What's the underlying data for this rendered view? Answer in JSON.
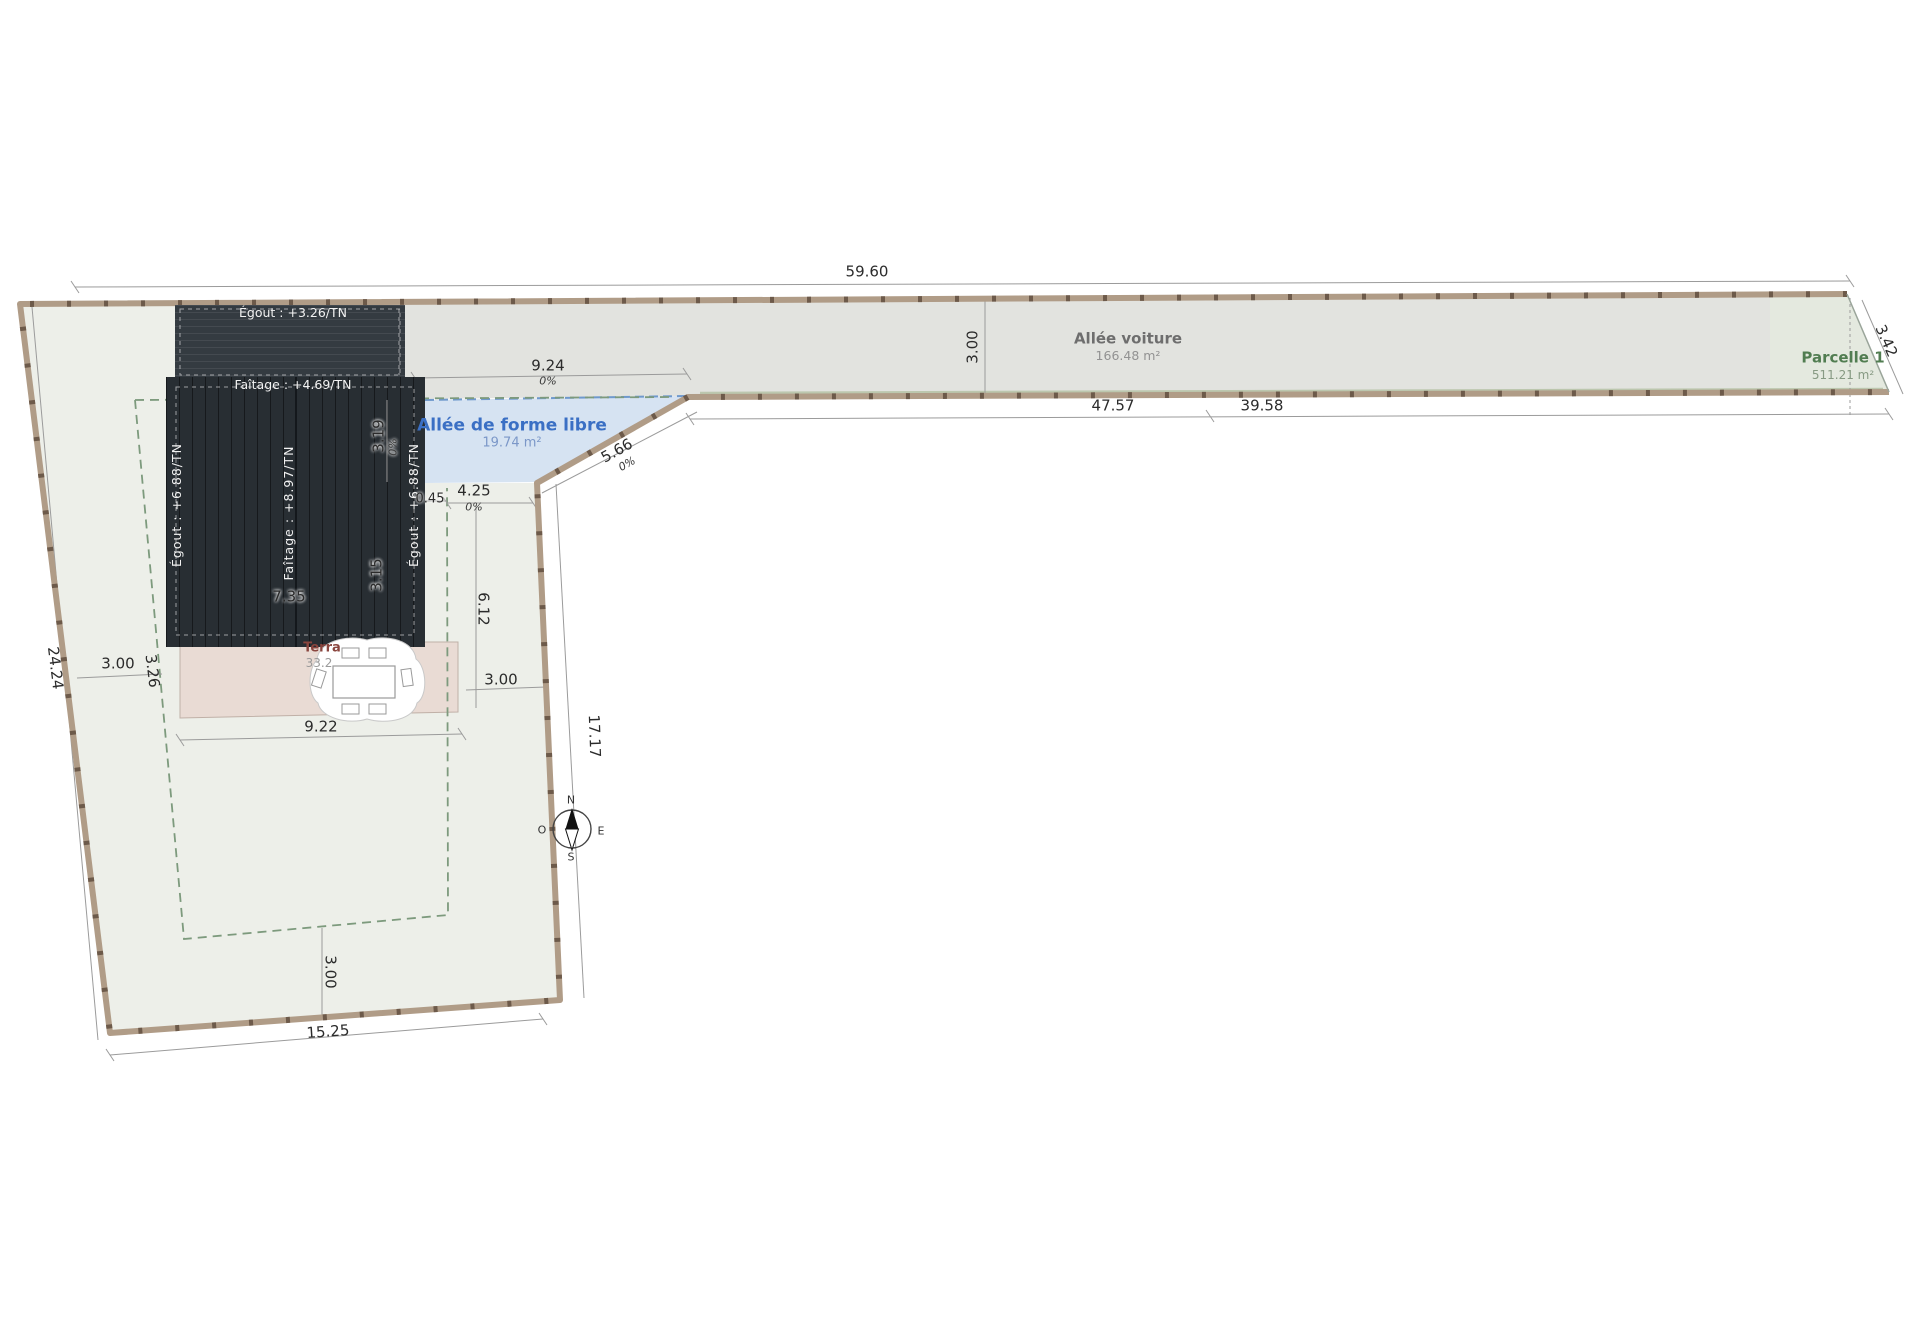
{
  "plan": {
    "dim_top": "59.60",
    "dim_strip_width": "3.00",
    "dim_4757": "47.57",
    "dim_3958": "39.58",
    "dim_342": "3.42",
    "dim_924": "9.24",
    "dim_566": "5.66",
    "dim_319": "3.19",
    "dim_315": "3.15",
    "dim_045": "0.45",
    "dim_425": "4.25",
    "dim_612": "6.12",
    "dim_735": "7.35",
    "dim_2424": "24.24",
    "dim_300_left": "3.00",
    "dim_326": "3.26",
    "dim_922": "9.22",
    "dim_300_terrace": "3.00",
    "dim_1717": "17.17",
    "dim_300_bottom": "3.00",
    "dim_1525": "15.25",
    "slope_zero": "0%"
  },
  "areas": {
    "allee_voiture": {
      "name": "Allée voiture",
      "size": "166.48 m²"
    },
    "allee_libre": {
      "name": "Allée de forme libre",
      "size": "19.74 m²"
    },
    "parcelle1": {
      "name": "Parcelle 1",
      "size": "511.21 m²"
    },
    "terrasse": {
      "name": "Terra",
      "size": "33.2"
    }
  },
  "roof": {
    "egout_low": "Égout : +3.26/TN",
    "faitage_low": "Faîtage : +4.69/TN",
    "egout_left": "Égout : +6.88/TN",
    "faitage_high": "Faîtage : +8.97/TN",
    "egout_right": "Égout : +6.88/TN"
  },
  "compass": {
    "north": "N",
    "south": "S",
    "east": "E",
    "west": "O"
  },
  "colors": {
    "parcel_fill": "#edefe9",
    "driveway_fill": "#e2e3df",
    "parcelle_tint": "#e4e9df",
    "allee_blue_fill": "#d6e3f2",
    "terrace_fill": "#e9dbd4",
    "roof_main": "#282e33",
    "roof_low": "#343b41",
    "fence": "#b09c87",
    "fence_dark": "#6d5a4a",
    "setback_green": "#7d9a7d",
    "dim_line": "#9b9b9b"
  }
}
